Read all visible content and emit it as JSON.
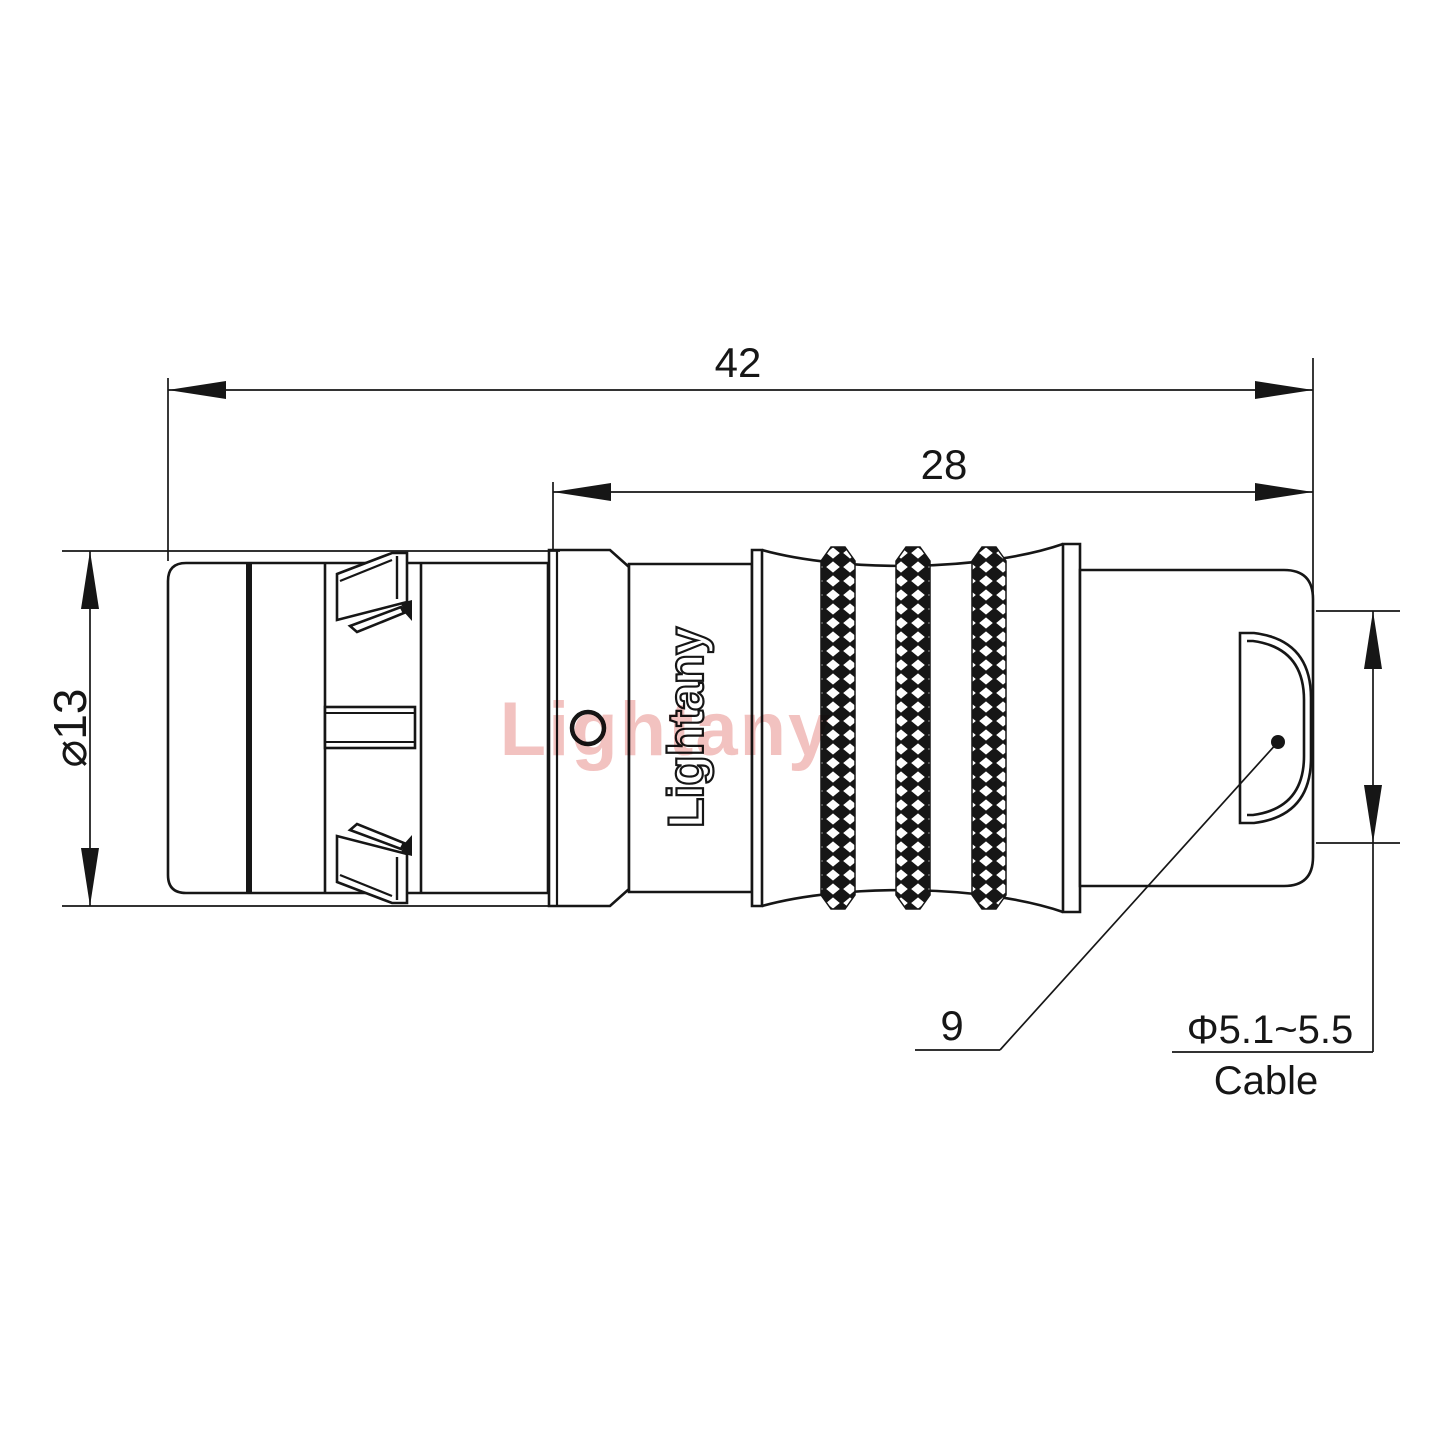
{
  "title": "Connector dimension drawing",
  "dimensions": {
    "overall_length": "42",
    "rear_section_length": "28",
    "shell_diameter": "⌀13",
    "boot_ref": "9",
    "cable_diameter_range": "Φ5.1~5.5",
    "cable_label": "Cable"
  },
  "branding": {
    "product_logo_text": "Lightany",
    "watermark_text": "Lightany"
  },
  "colors": {
    "ink": "#161616",
    "watermark": "#f0b7b5",
    "background": "#ffffff"
  }
}
